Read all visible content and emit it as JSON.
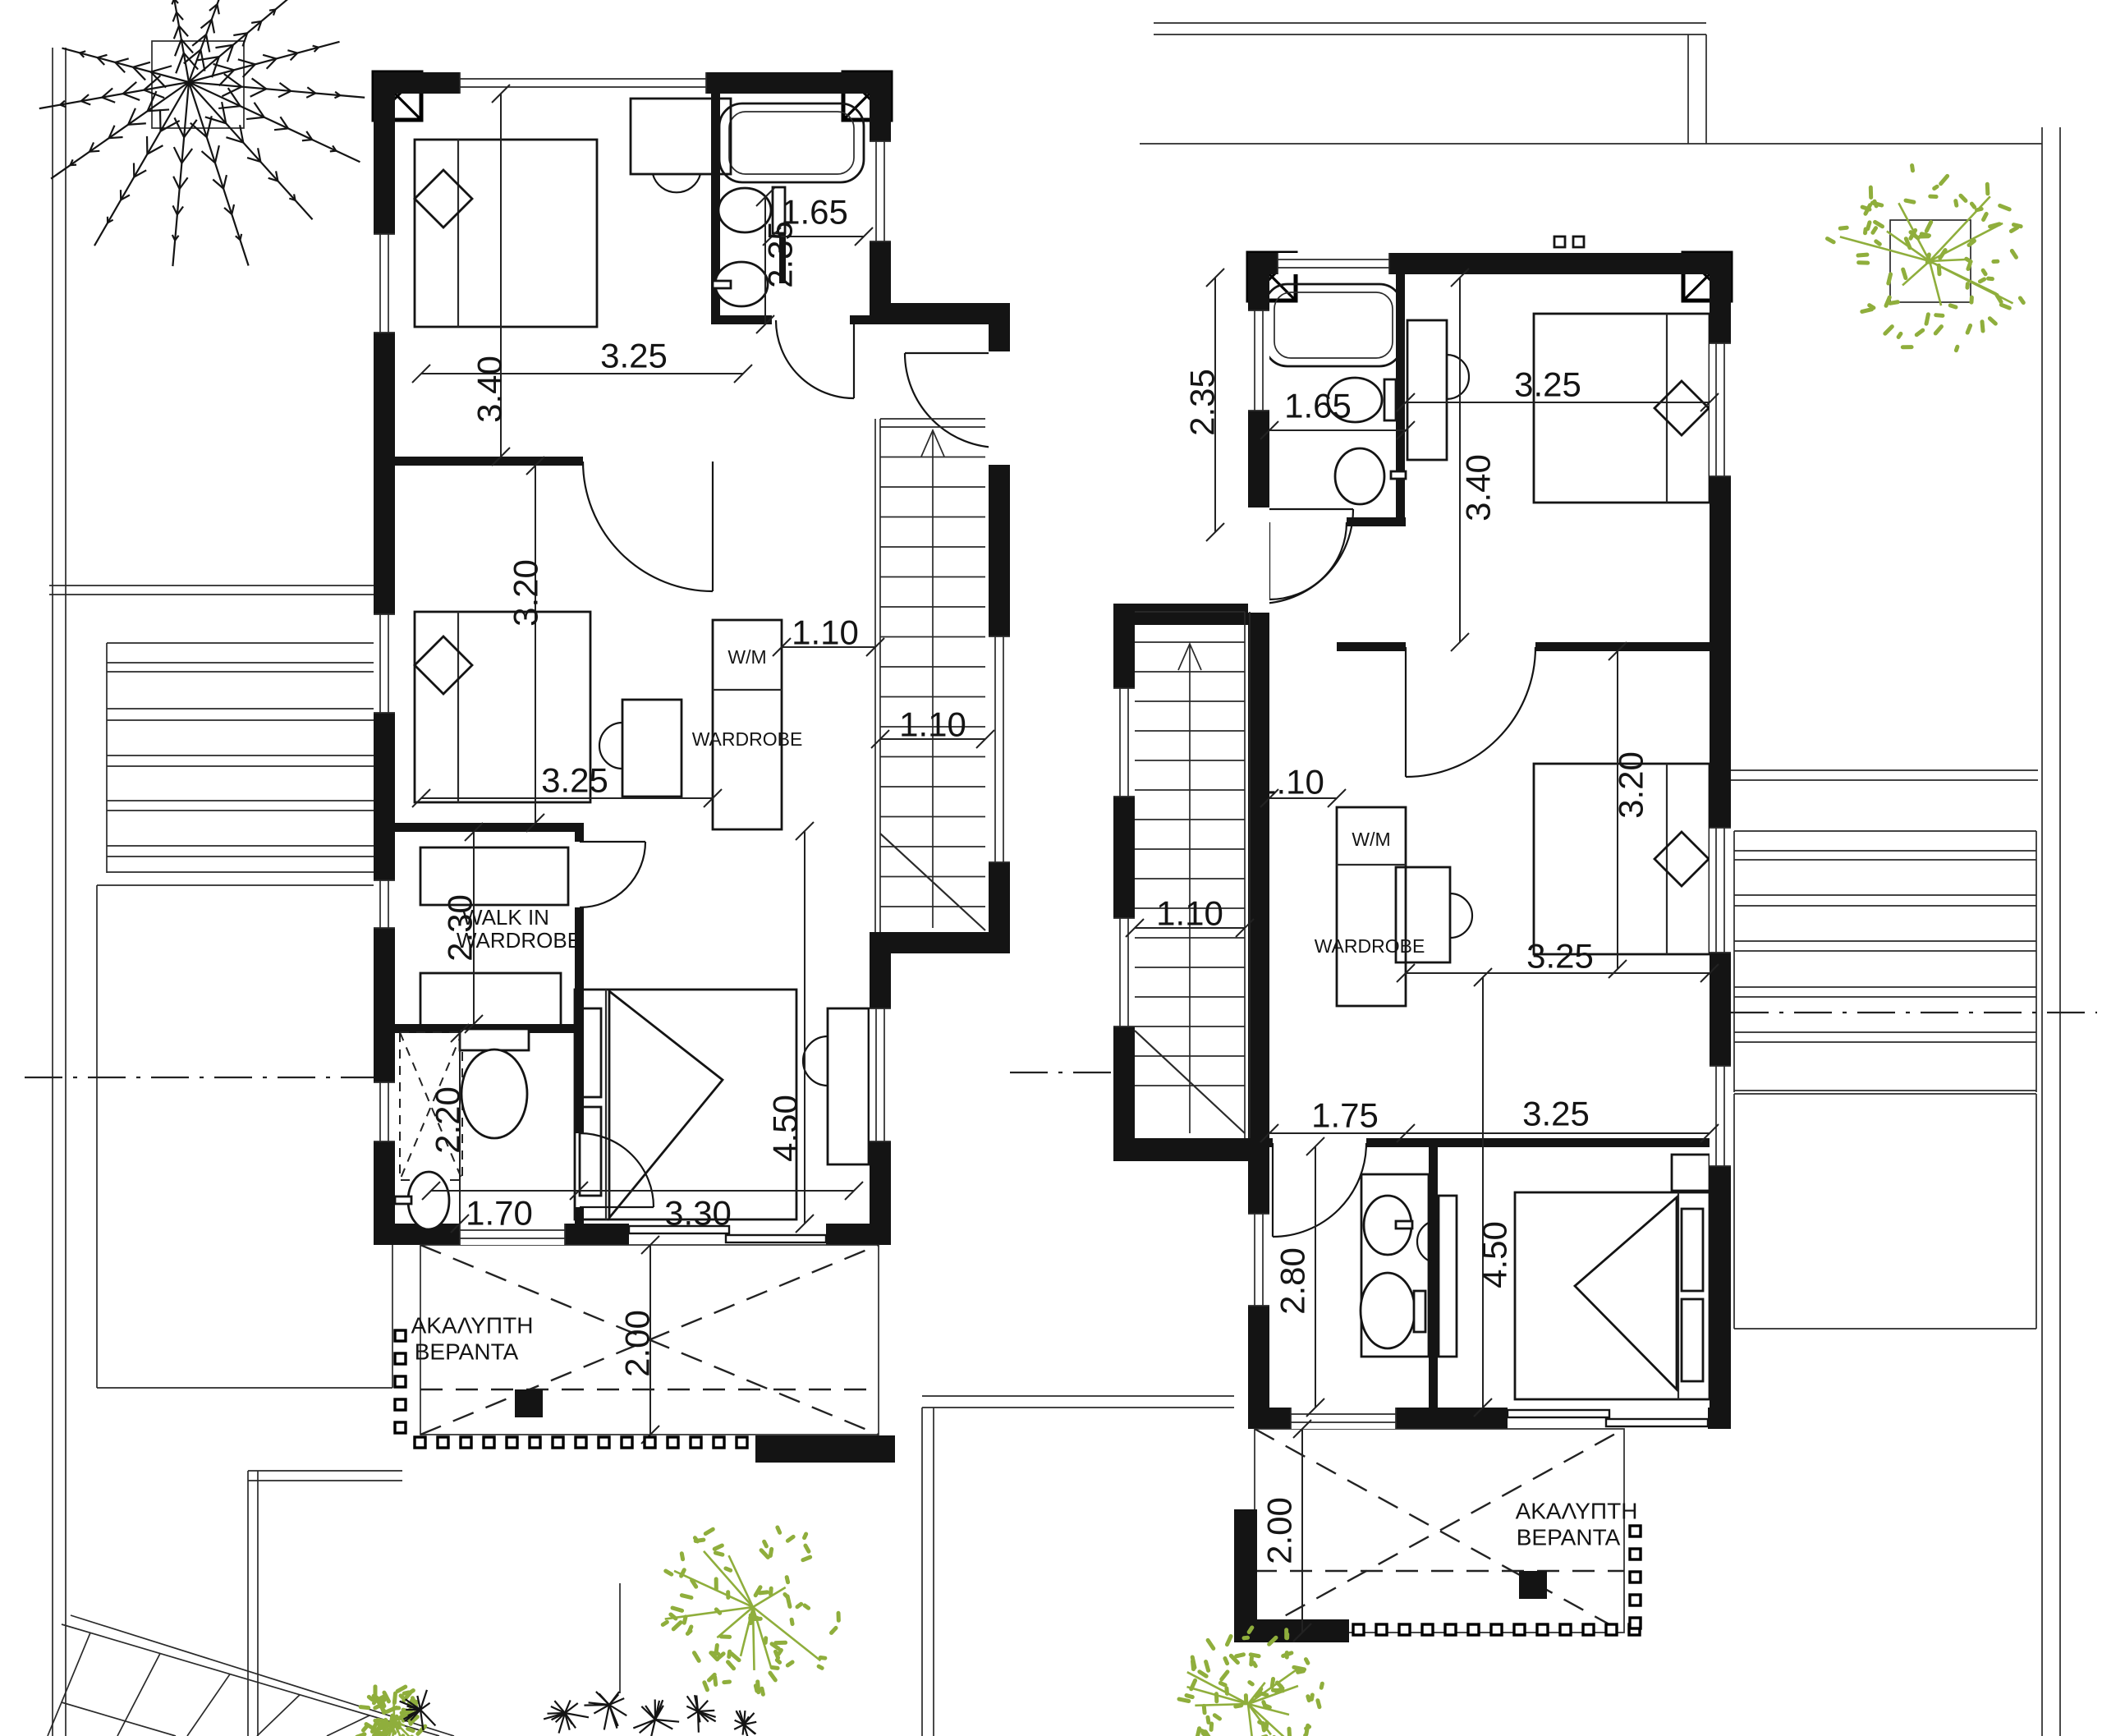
{
  "drawing": {
    "discipline": "architectural first floor plan - two mirrored villas",
    "colors": {
      "ink": "#141414",
      "vegetation_green": "#8fae3c",
      "paper": "#ffffff"
    }
  },
  "villa_left": {
    "labels": {
      "walk_in_line1": "WALK IN",
      "walk_in_line2": "WARDROBE",
      "laundry": "W/M",
      "wardrobe": "WARDROBE",
      "veranda_line1": "ΑΚΑΛΥΠΤΗ",
      "veranda_line2": "ΒΕΡΑΝΤΑ"
    },
    "dimensions": {
      "bath_width": "1.65",
      "bath_depth": "2.35",
      "bedroom1_width": "3.25",
      "bedroom1_depth": "3.40",
      "bedroom2_depth": "3.20",
      "bedroom2_width": "3.25",
      "hall_width": "1.10",
      "stair_width": "1.10",
      "walk_in_depth": "2.30",
      "wc_depth": "2.20",
      "wc_width": "1.70",
      "master_width": "3.30",
      "master_depth": "4.50",
      "veranda_depth": "2.00"
    }
  },
  "villa_right": {
    "labels": {
      "laundry": "W/M",
      "wardrobe": "WARDROBE",
      "veranda_line1": "ΑΚΑΛΥΠΤΗ",
      "veranda_line2": "ΒΕΡΑΝΤΑ"
    },
    "dimensions": {
      "bath_depth": "2.35",
      "bath_width": "1.65",
      "bedroom1_width": "3.25",
      "bedroom1_depth": "3.40",
      "hall_width": "1.10",
      "stair_width": "1.10",
      "bedroom2_depth": "3.20",
      "bedroom2_width": "3.25",
      "bath2_width": "1.75",
      "bath2_depth": "2.80",
      "master_width": "3.25",
      "master_depth": "4.50",
      "veranda_depth": "2.00"
    }
  }
}
